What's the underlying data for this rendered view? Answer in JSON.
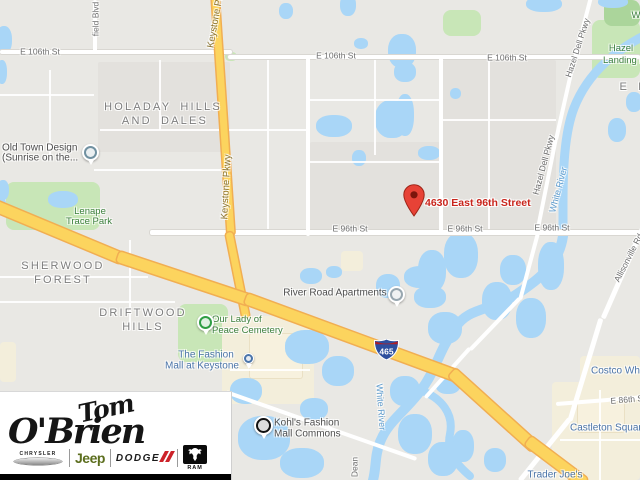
{
  "colors": {
    "land": "#e9e8e4",
    "land_dark": "#e3e1dd",
    "water": "#a9d6f7",
    "park": "#c8e6b7",
    "park_dark": "#abd59b",
    "commercial": "#f3eedb",
    "building": "#f7f1de",
    "road": "#ffffff",
    "road_casing": "#d9d7d2",
    "highway": "#fcd45e",
    "highway_casing": "#f1ae52",
    "street_label": "#6e6e6e",
    "hwy_label": "#8a7430",
    "nbhd_label": "#7d7d7d",
    "park_label": "#3f8140",
    "water_label": "#5d9bcd",
    "poi_label": "#4e4e4e",
    "shop_label": "#4a74a9",
    "address_red": "#c9251c",
    "pin_red": "#e74236",
    "shield_blue": "#2d4f9e",
    "shield_red": "#b01f24",
    "jeep_green": "#5c6e1e",
    "dodge_red": "#cc2229"
  },
  "map": {
    "address": "4630 East 96th Street",
    "shield": "465",
    "labels": [
      {
        "name": "street-e106-left",
        "text": "E 106th St",
        "x": 40,
        "y": 52,
        "rot": 0,
        "cls": "street",
        "anchor": "c",
        "inter": false
      },
      {
        "name": "street-e106-mid",
        "text": "E 106th St",
        "x": 336,
        "y": 56,
        "rot": 0,
        "cls": "street",
        "anchor": "c",
        "inter": false
      },
      {
        "name": "street-e106-right",
        "text": "E 106th St",
        "x": 507,
        "y": 58,
        "rot": 0,
        "cls": "street",
        "anchor": "c",
        "inter": false
      },
      {
        "name": "street-e96-left",
        "text": "E 96th St",
        "x": 350,
        "y": 229,
        "rot": 0,
        "cls": "street",
        "anchor": "c",
        "inter": false
      },
      {
        "name": "street-e96-mid",
        "text": "E 96th St",
        "x": 465,
        "y": 229,
        "rot": 0,
        "cls": "street",
        "anchor": "c",
        "inter": false
      },
      {
        "name": "street-e96-right",
        "text": "E 96th St",
        "x": 552,
        "y": 228,
        "rot": 0,
        "cls": "street",
        "anchor": "c",
        "inter": false
      },
      {
        "name": "street-e86",
        "text": "E 86th St",
        "x": 628,
        "y": 400,
        "rot": -5,
        "cls": "street",
        "anchor": "c",
        "inter": false
      },
      {
        "name": "street-westfield-blvd",
        "text": "field Blvd",
        "x": 96,
        "y": 19,
        "rot": -90,
        "cls": "street",
        "anchor": "c",
        "inter": false
      },
      {
        "name": "street-dean-rd",
        "text": "Dean",
        "x": 355,
        "y": 467,
        "rot": -90,
        "cls": "street",
        "anchor": "c",
        "inter": false
      },
      {
        "name": "road-keystone-pkwy-top",
        "text": "Keystone Pkwy",
        "x": 217,
        "y": 16,
        "rot": -80,
        "cls": "hwy",
        "anchor": "c",
        "inter": false
      },
      {
        "name": "road-keystone-pkwy-mid",
        "text": "Keystone Pkwy",
        "x": 227,
        "y": 187,
        "rot": -87,
        "cls": "hwy",
        "anchor": "c",
        "inter": false
      },
      {
        "name": "street-hazel-dell-top",
        "text": "Hazel Dell Pkwy",
        "x": 578,
        "y": 48,
        "rot": -72,
        "cls": "street",
        "anchor": "c",
        "inter": false
      },
      {
        "name": "street-hazel-dell-mid",
        "text": "Hazel Dell Pkwy",
        "x": 544,
        "y": 165,
        "rot": -75,
        "cls": "street",
        "anchor": "c",
        "inter": false
      },
      {
        "name": "street-allisonville-rd",
        "text": "Allisonville Rd",
        "x": 629,
        "y": 258,
        "rot": -63,
        "cls": "street",
        "anchor": "c",
        "inter": false
      },
      {
        "name": "water-white-river-top",
        "text": "White River",
        "x": 559,
        "y": 190,
        "rot": -75,
        "cls": "water-l",
        "anchor": "c",
        "inter": false
      },
      {
        "name": "water-white-river-bottom",
        "text": "White River",
        "x": 380,
        "y": 407,
        "rot": 86,
        "cls": "water-l",
        "anchor": "c",
        "inter": false
      },
      {
        "name": "nbhd-holaday-line1",
        "text": "HOLADAY HILLS",
        "x": 163,
        "y": 107,
        "rot": 0,
        "cls": "nbhd",
        "anchor": "c",
        "inter": false
      },
      {
        "name": "nbhd-holaday-line2",
        "text": "AND DALES",
        "x": 165,
        "y": 121,
        "rot": 0,
        "cls": "nbhd",
        "anchor": "c",
        "inter": false
      },
      {
        "name": "nbhd-sherwood-line1",
        "text": "SHERWOOD",
        "x": 63,
        "y": 266,
        "rot": 0,
        "cls": "nbhd",
        "anchor": "c",
        "inter": false
      },
      {
        "name": "nbhd-sherwood-line2",
        "text": "FOREST",
        "x": 63,
        "y": 280,
        "rot": 0,
        "cls": "nbhd",
        "anchor": "c",
        "inter": false
      },
      {
        "name": "nbhd-driftwood-line1",
        "text": "DRIFTWOOD",
        "x": 143,
        "y": 313,
        "rot": 0,
        "cls": "nbhd",
        "anchor": "c",
        "inter": false
      },
      {
        "name": "nbhd-driftwood-line2",
        "text": "HILLS",
        "x": 143,
        "y": 327,
        "rot": 0,
        "cls": "nbhd",
        "anchor": "c",
        "inter": false
      },
      {
        "name": "nbhd-el-fragment",
        "text": "E L",
        "x": 633,
        "y": 87,
        "rot": 0,
        "cls": "nbhd",
        "anchor": "c",
        "inter": false
      },
      {
        "name": "park-lenape-line1",
        "text": "Lenape",
        "x": 90,
        "y": 212,
        "rot": 0,
        "cls": "park-l",
        "anchor": "c",
        "inter": false
      },
      {
        "name": "park-lenape-line2",
        "text": "Trace Park",
        "x": 89,
        "y": 222,
        "rot": 0,
        "cls": "park-l",
        "anchor": "c",
        "inter": false
      },
      {
        "name": "park-hazel-landing-line1",
        "text": "Hazel",
        "x": 621,
        "y": 49,
        "rot": 0,
        "cls": "park-l",
        "anchor": "c",
        "inter": false
      },
      {
        "name": "park-hazel-landing-line2",
        "text": "Landing Park",
        "x": 603,
        "y": 61,
        "rot": 0,
        "cls": "park-l",
        "anchor": "l",
        "inter": false
      },
      {
        "name": "park-w-fragment",
        "text": "W",
        "x": 636,
        "y": 16,
        "rot": 0,
        "cls": "park-l",
        "anchor": "c",
        "inter": false
      },
      {
        "name": "poi-our-lady-line1",
        "text": "Our Lady of",
        "x": 212,
        "y": 320,
        "rot": 0,
        "cls": "park-l",
        "anchor": "l",
        "inter": true
      },
      {
        "name": "poi-our-lady-line2",
        "text": "Peace Cemetery",
        "x": 212,
        "y": 331,
        "rot": 0,
        "cls": "park-l",
        "anchor": "l",
        "inter": true
      },
      {
        "name": "poi-old-town-line1",
        "text": "Old Town Design",
        "x": 2,
        "y": 148,
        "rot": 0,
        "cls": "poi",
        "anchor": "l",
        "inter": true
      },
      {
        "name": "poi-old-town-line2",
        "text": "(Sunrise on the...",
        "x": 2,
        "y": 158,
        "rot": 0,
        "cls": "poi",
        "anchor": "l",
        "inter": true
      },
      {
        "name": "poi-river-road-apartments",
        "text": "River Road Apartments",
        "x": 335,
        "y": 293,
        "rot": 0,
        "cls": "poi",
        "anchor": "c",
        "inter": true
      },
      {
        "name": "poi-kohls-line1",
        "text": "Kohl's Fashion",
        "x": 274,
        "y": 423,
        "rot": 0,
        "cls": "poi",
        "anchor": "l",
        "inter": true
      },
      {
        "name": "poi-kohls-line2",
        "text": "Mall Commons",
        "x": 274,
        "y": 434,
        "rot": 0,
        "cls": "poi",
        "anchor": "l",
        "inter": true
      },
      {
        "name": "shop-fashion-mall-line1",
        "text": "The Fashion",
        "x": 206,
        "y": 355,
        "rot": 0,
        "cls": "shop",
        "anchor": "c",
        "inter": true
      },
      {
        "name": "shop-fashion-mall-line2",
        "text": "Mall at Keystone",
        "x": 202,
        "y": 366,
        "rot": 0,
        "cls": "shop",
        "anchor": "c",
        "inter": true
      },
      {
        "name": "shop-castleton-square",
        "text": "Castleton Square",
        "x": 570,
        "y": 428,
        "rot": 0,
        "cls": "shop",
        "anchor": "l",
        "inter": true
      },
      {
        "name": "shop-costco",
        "text": "Costco Wholesale",
        "x": 591,
        "y": 371,
        "rot": 0,
        "cls": "shop",
        "anchor": "l",
        "inter": true
      },
      {
        "name": "shop-trader-joes",
        "text": "Trader Joe's",
        "x": 555,
        "y": 475,
        "rot": 0,
        "cls": "shop",
        "anchor": "c",
        "inter": true
      }
    ]
  },
  "logo": {
    "line1": "Tom",
    "line2": "O'Brien",
    "chrysler": "CHRYSLER",
    "jeep": "Jeep",
    "dodge": "DODGE",
    "ram": "RAM"
  }
}
